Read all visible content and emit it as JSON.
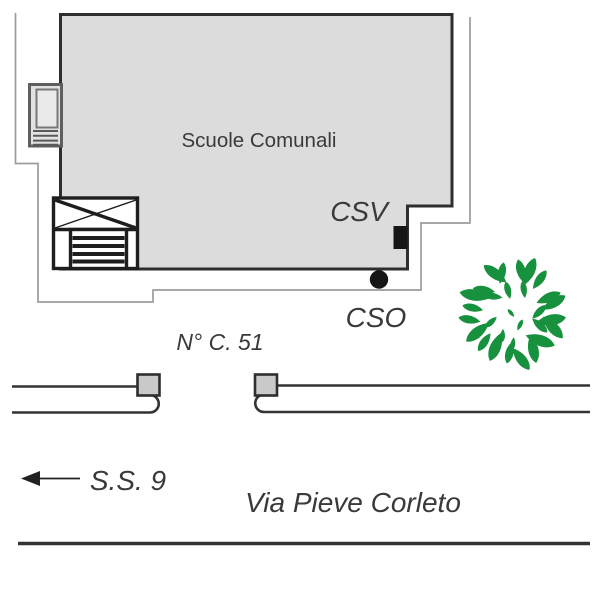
{
  "title": "Scuole Comunali site plan",
  "map": {
    "building_label": "Scuole Comunali",
    "csv_label": "CSV",
    "cso_label": "CSO",
    "civic_number_label": "N° C. 51",
    "highway_label": "S.S. 9",
    "street_label": "Via Pieve Corleto"
  },
  "colors": {
    "background": "#ffffff",
    "building_fill": "#dcdcdc",
    "building_border": "#2e2e2e",
    "boundary_line": "#9c9c9c",
    "road_line": "#333333",
    "gate_fill": "#c9c9c9",
    "marker_black": "#161616",
    "tree_green": "#17913d",
    "text_color": "#3a3a3a"
  }
}
